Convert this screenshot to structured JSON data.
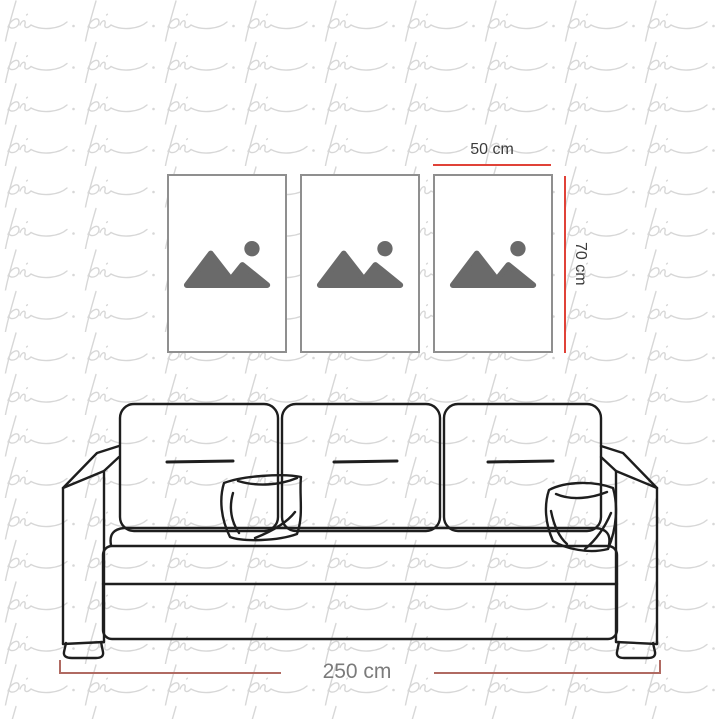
{
  "watermark": {
    "text": "pi"
  },
  "dimensions": {
    "frame_width_label": "50 cm",
    "frame_height_label": "70 cm",
    "sofa_width_label": "250 cm"
  },
  "frames": {
    "count": 3,
    "items": [
      {
        "icon": "image-placeholder-icon"
      },
      {
        "icon": "image-placeholder-icon"
      },
      {
        "icon": "image-placeholder-icon"
      }
    ]
  },
  "sofa": {
    "cushions": 3,
    "pillows": 2,
    "style": "black outline line-art"
  },
  "colors": {
    "accent_red": "#e04238",
    "dim_red": "#b06a62",
    "frame_label": "#3c3c3c",
    "sofa_label": "#7b7b7b",
    "frame_border": "#8f8f8f",
    "icon_gray": "#6a6a6a",
    "sofa_ink": "#1e1e1e",
    "watermark": "#d7d7d7"
  }
}
